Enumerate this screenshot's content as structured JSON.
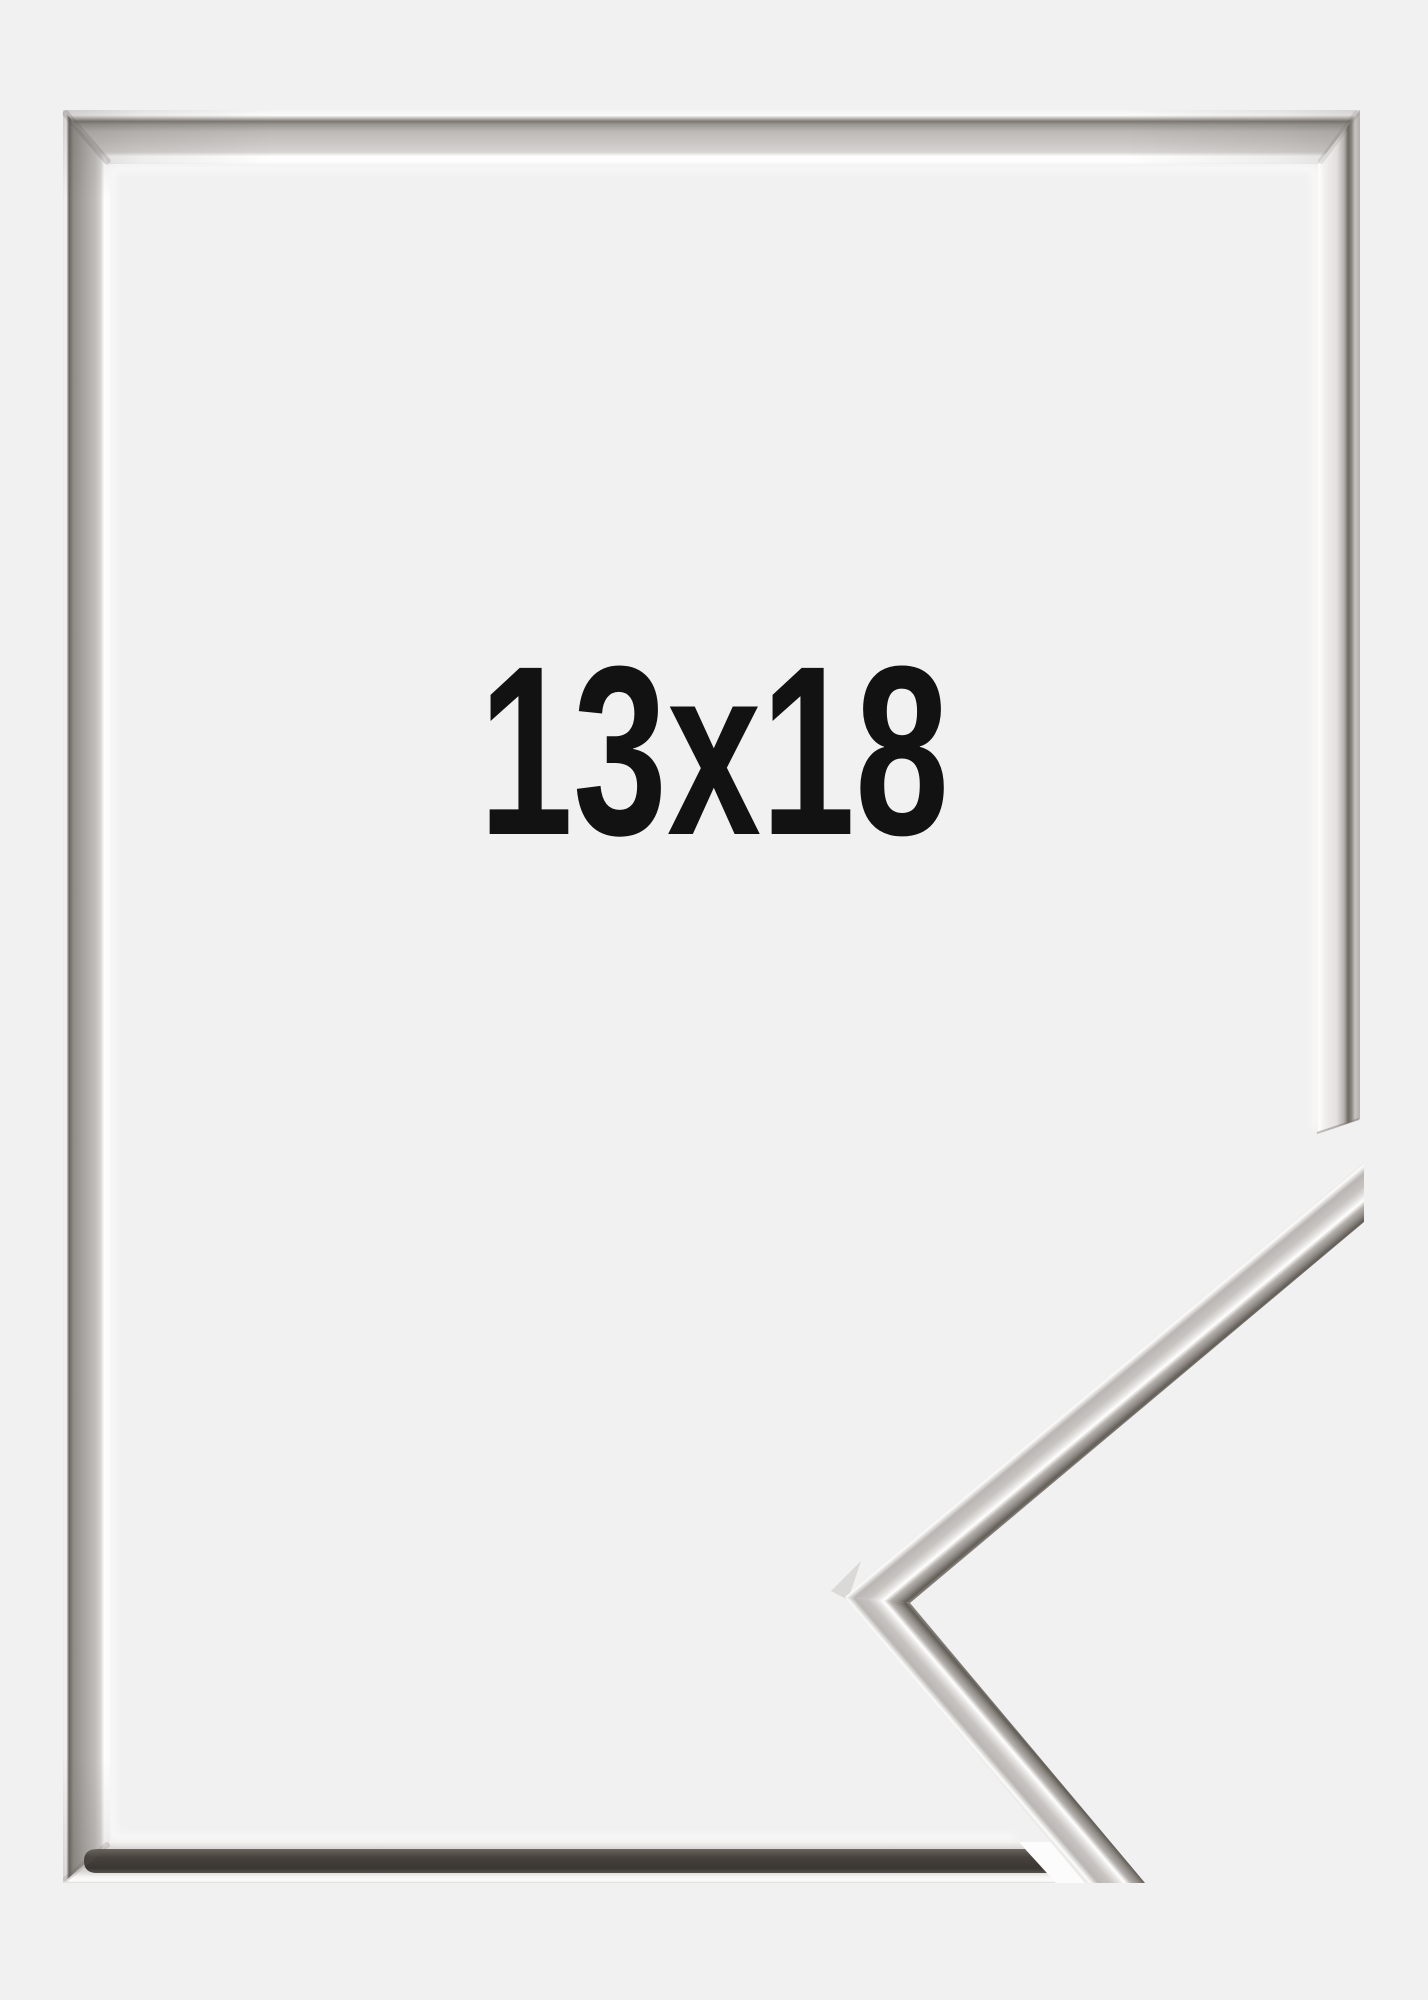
{
  "product": {
    "size_label": "13x18"
  },
  "photo": {
    "background_color": "#f1f1f2",
    "label_color": "#121212",
    "chrome_colors": {
      "highlight": "#ffffff",
      "light": "#dcdad8",
      "mid": "#b5b2ae",
      "dark": "#6e6862",
      "shadow_band": "#3f3a35"
    }
  }
}
